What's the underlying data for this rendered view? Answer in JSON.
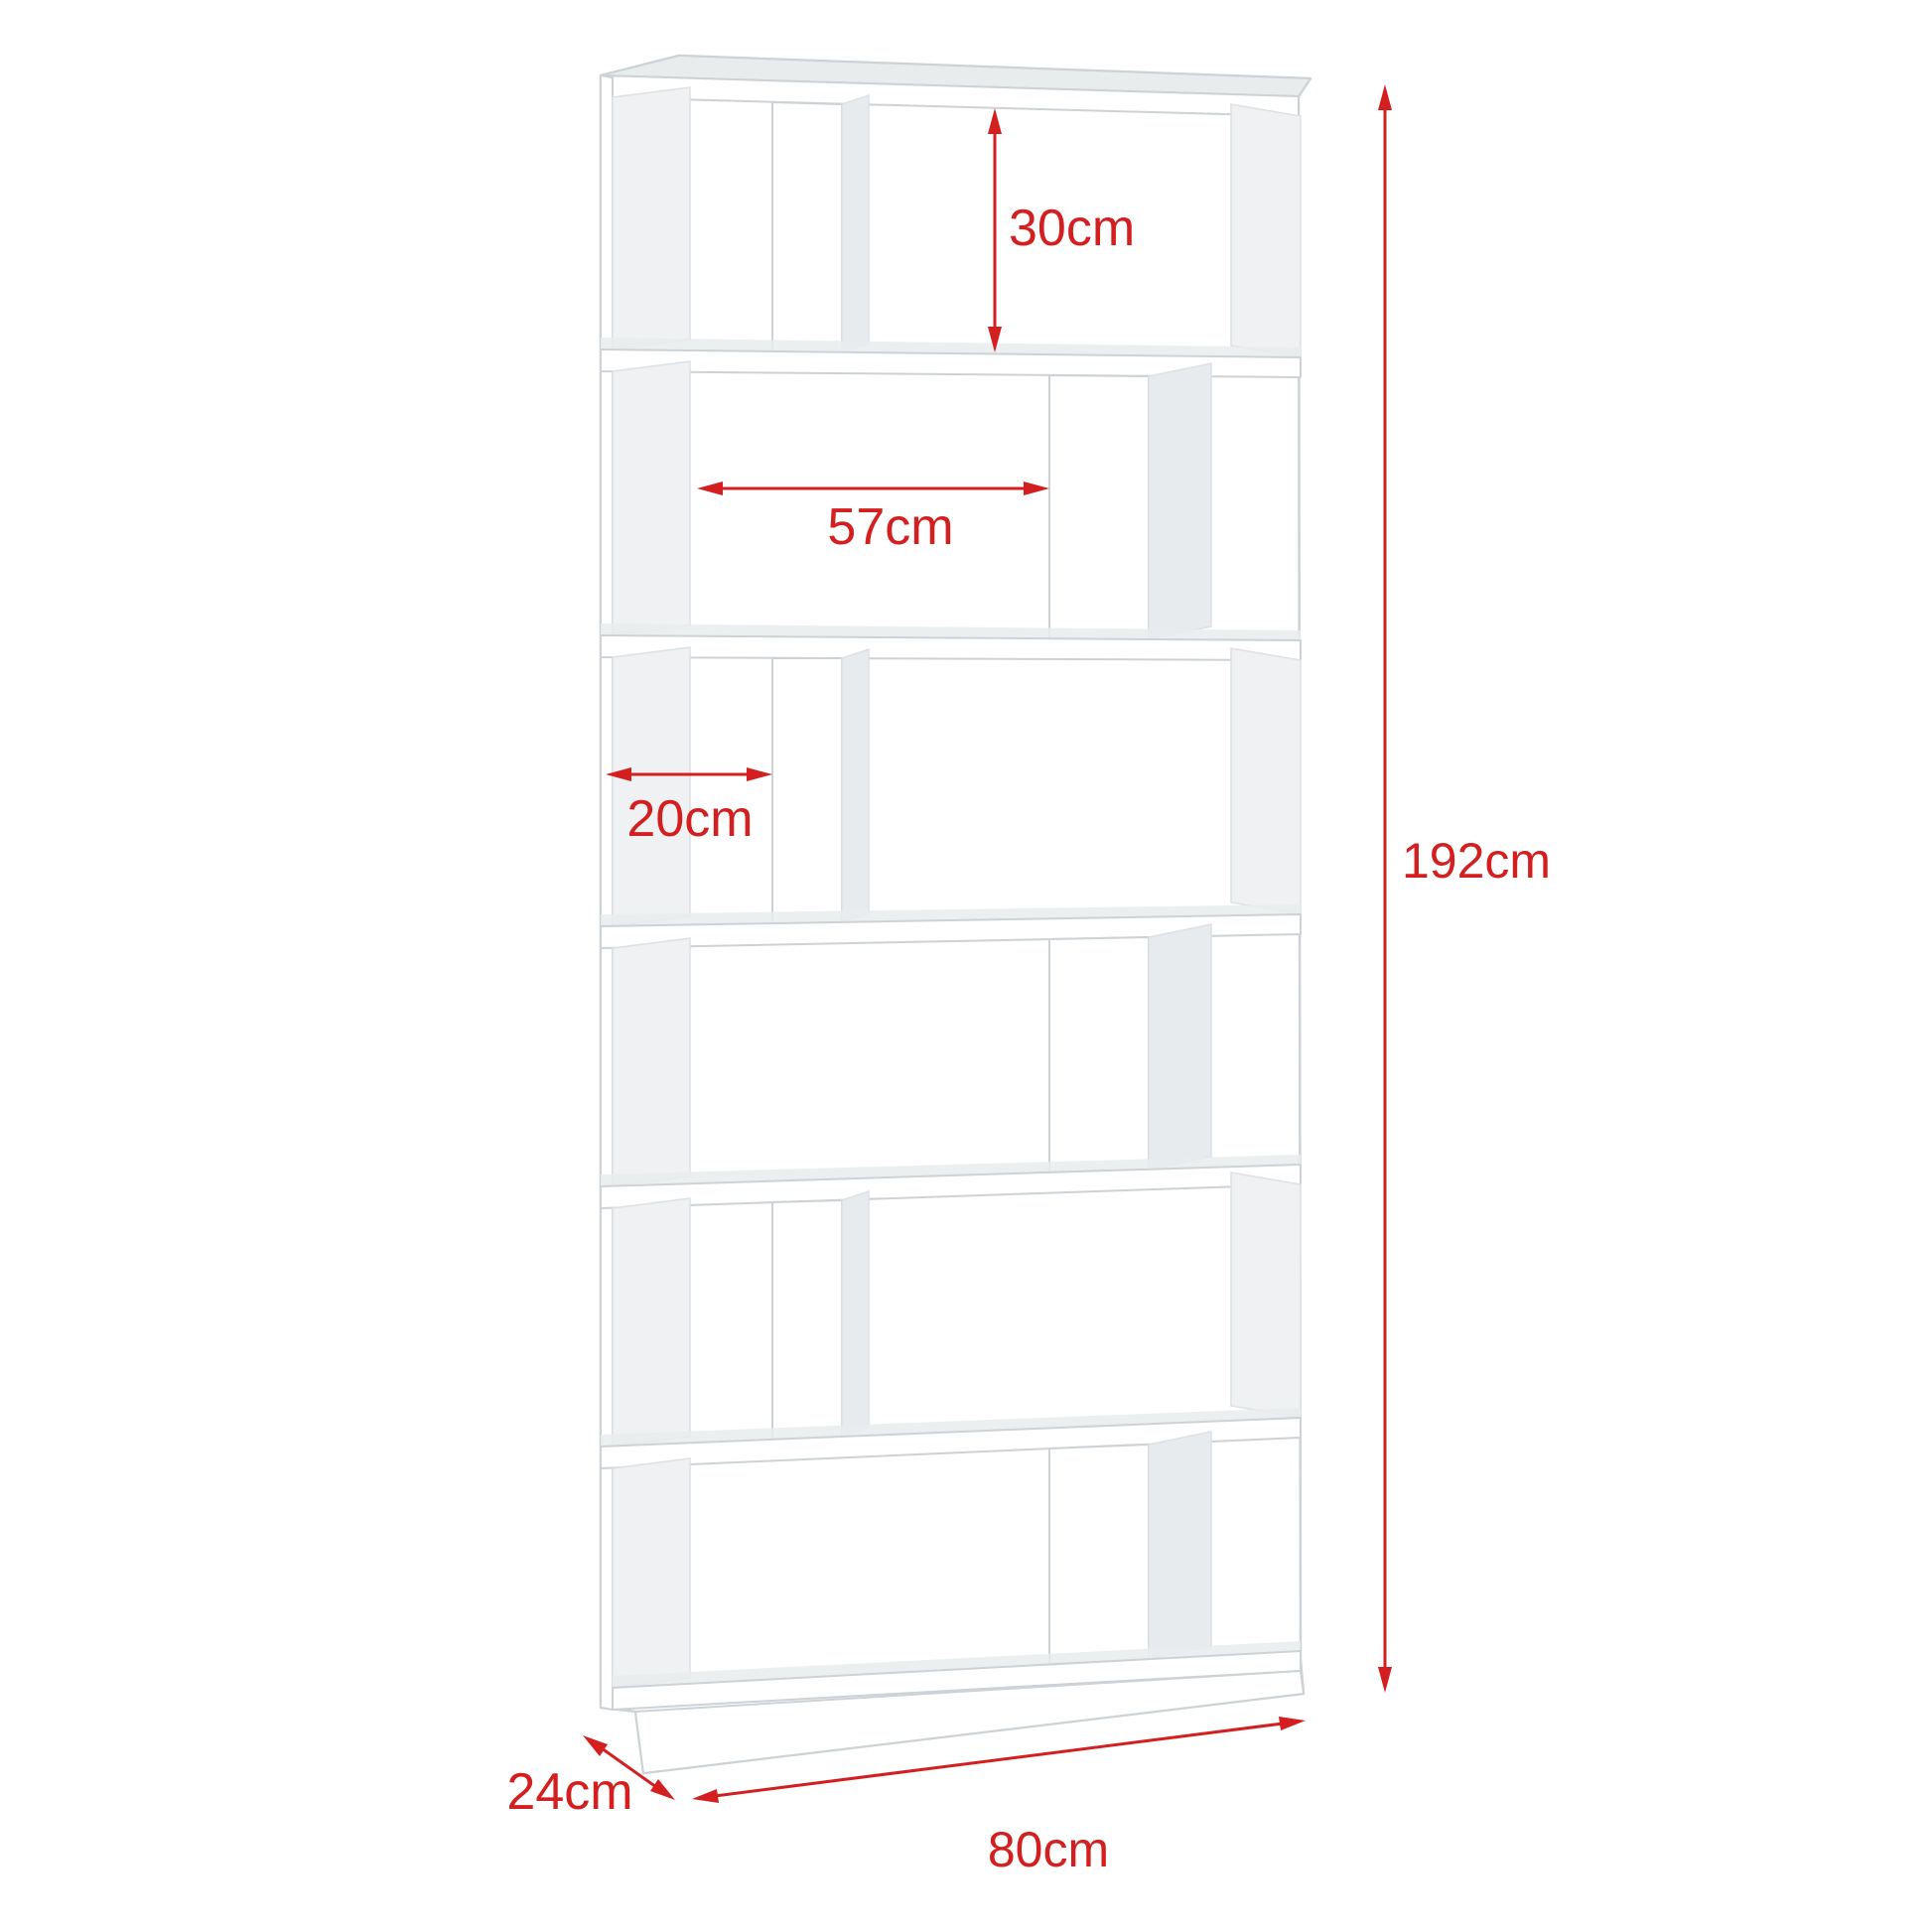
{
  "figure": {
    "type": "product-dimension-diagram",
    "subject": "zigzag-bookshelf-6-tier",
    "tiers": 6
  },
  "colors": {
    "dimension_red": "#d31f1f",
    "edge_gray": "#ccd2d5",
    "edge_gray_light": "#dde1e3",
    "top_face": "#e9eced",
    "side_shade": "#e8ebed",
    "side_shade_light": "#eff1f2",
    "background": "#ffffff"
  },
  "dimensions": {
    "compartment_height": {
      "label": "30cm"
    },
    "compartment_width": {
      "label": "57cm"
    },
    "side_compartment_width": {
      "label": "20cm"
    },
    "total_height": {
      "label": "192cm"
    },
    "depth": {
      "label": "24cm"
    },
    "total_width": {
      "label": "80cm"
    }
  }
}
